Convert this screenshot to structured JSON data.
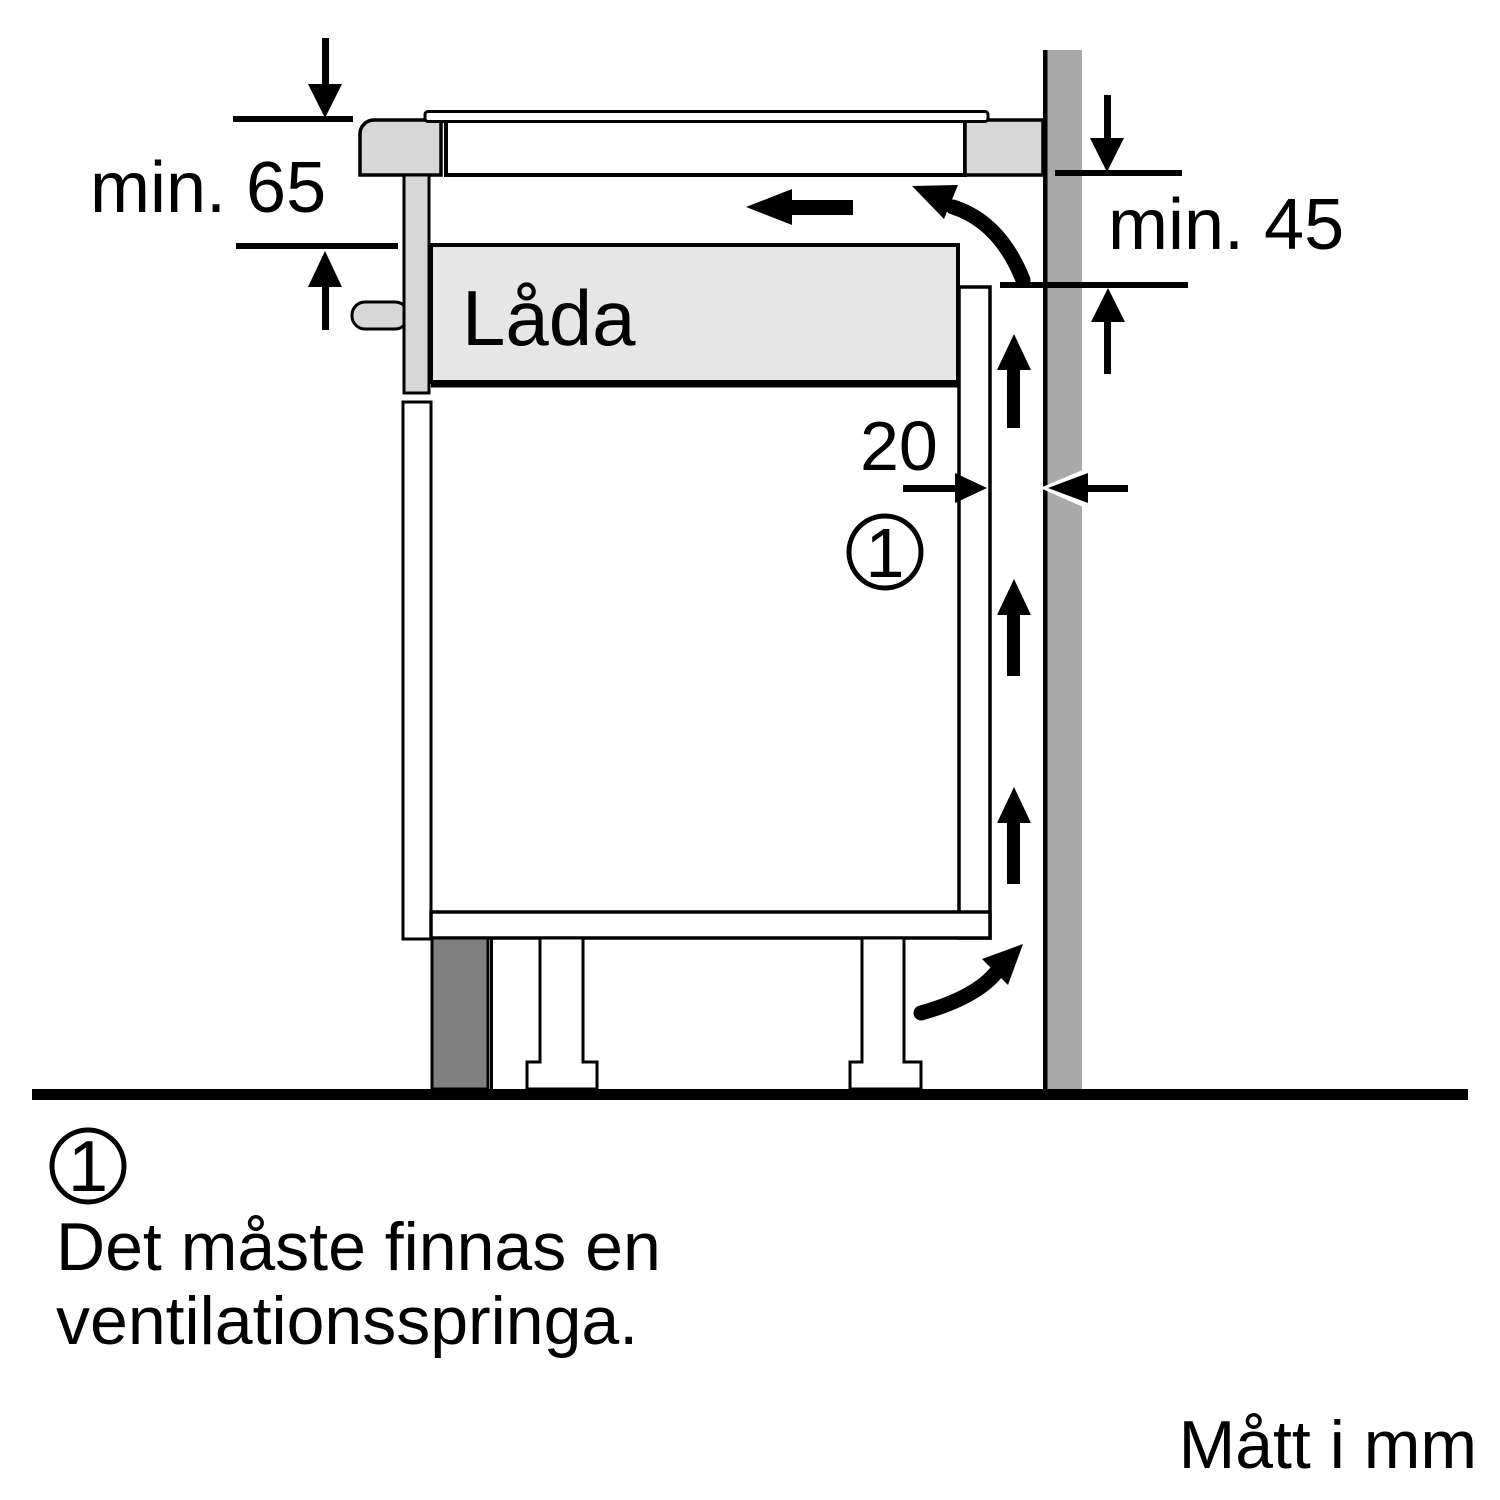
{
  "diagram": {
    "labels": {
      "min_65": "min. 65",
      "min_45": "min. 45",
      "gap_20": "20",
      "drawer": "Låda",
      "callout_1": "1"
    },
    "legend": {
      "marker": "1",
      "line1": "Det måste finnas en",
      "line2": "ventilationsspringa."
    },
    "footer_note": "Mått i mm",
    "colors": {
      "wall": "#a9a9a9",
      "plinth": "#808080",
      "panel_light": "#d7d7d7",
      "drawer_fill": "#e6e6e6",
      "line": "#000000",
      "background": "#ffffff"
    }
  }
}
